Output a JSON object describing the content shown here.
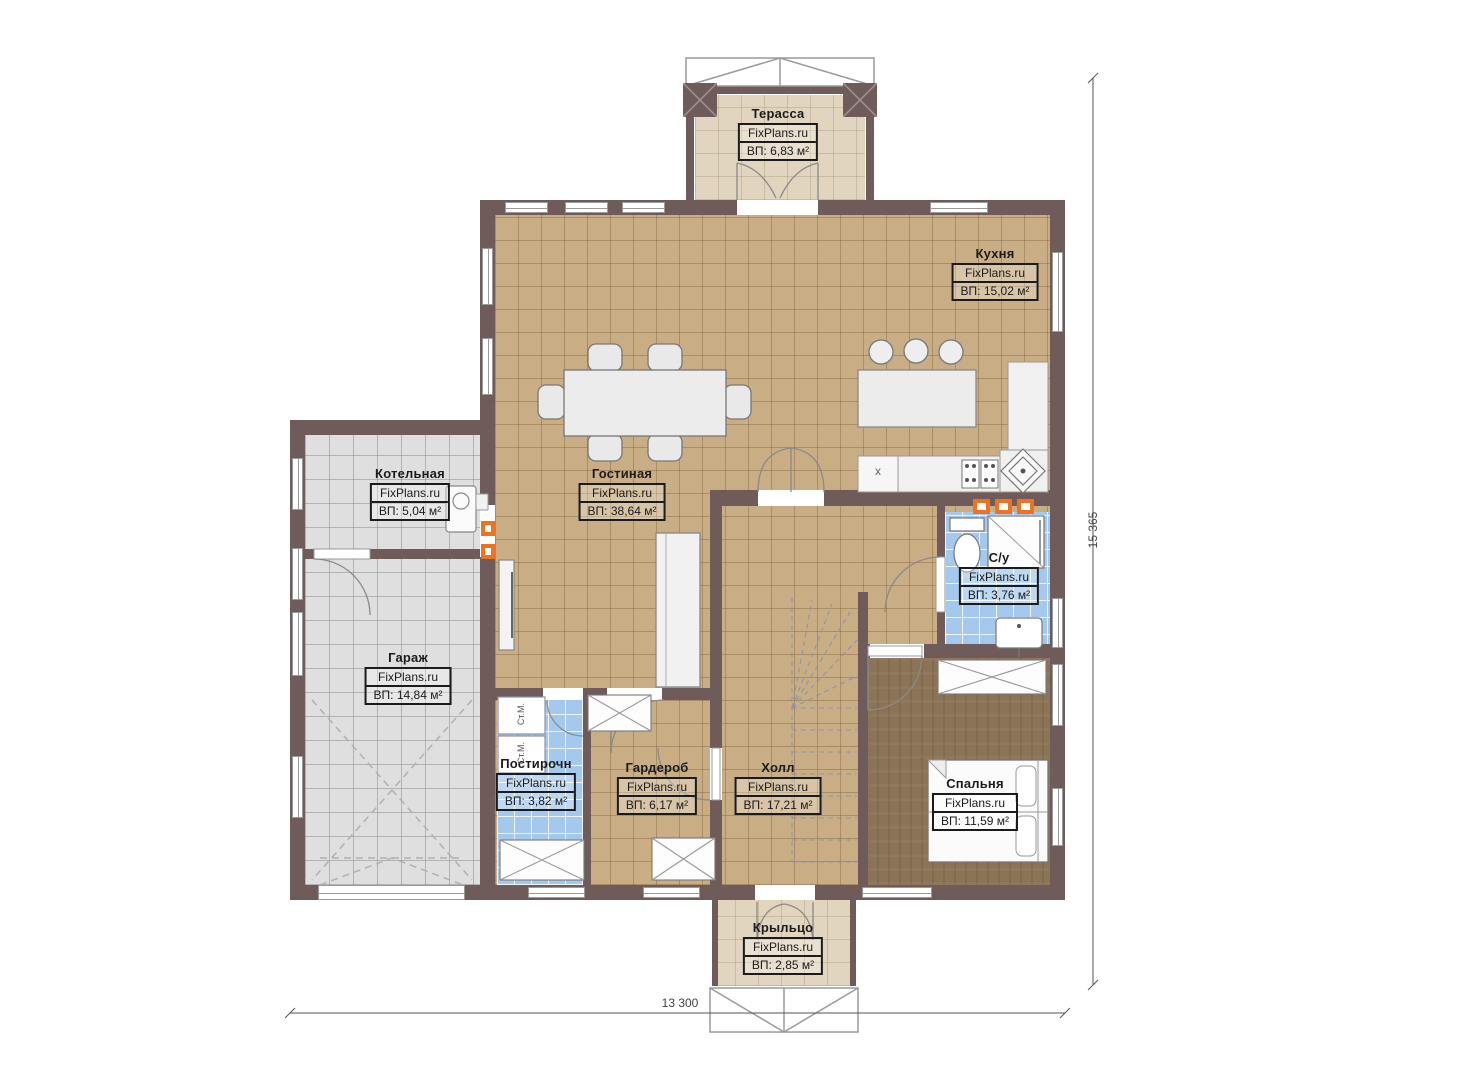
{
  "brand": "FixPlans.ru",
  "rooms": [
    {
      "id": "terrace",
      "name": "Терасса",
      "brand": "FixPlans.ru",
      "area": "ВП: 6,83 м²"
    },
    {
      "id": "kitchen",
      "name": "Кухня",
      "brand": "FixPlans.ru",
      "area": "ВП: 15,02 м²"
    },
    {
      "id": "living",
      "name": "Гостиная",
      "brand": "FixPlans.ru",
      "area": "ВП: 38,64 м²"
    },
    {
      "id": "boiler",
      "name": "Котельная",
      "brand": "FixPlans.ru",
      "area": "ВП: 5,04 м²"
    },
    {
      "id": "garage",
      "name": "Гараж",
      "brand": "FixPlans.ru",
      "area": "ВП: 14,84 м²"
    },
    {
      "id": "bathroom",
      "name": "С/у",
      "brand": "FixPlans.ru",
      "area": "ВП: 3,76 м²"
    },
    {
      "id": "laundry",
      "name": "Постирочн",
      "brand": "FixPlans.ru",
      "area": "ВП: 3,82 м²"
    },
    {
      "id": "wardrobe",
      "name": "Гардероб",
      "brand": "FixPlans.ru",
      "area": "ВП: 6,17 м²"
    },
    {
      "id": "hall",
      "name": "Холл",
      "brand": "FixPlans.ru",
      "area": "ВП: 17,21 м²"
    },
    {
      "id": "bedroom",
      "name": "Спальня",
      "brand": "FixPlans.ru",
      "area": "ВП: 11,59 м²"
    },
    {
      "id": "porch",
      "name": "Крыльцо",
      "brand": "FixPlans.ru",
      "area": "ВП: 2,85 м²"
    }
  ],
  "dimensions": {
    "width": "13 300",
    "height": "15 365"
  },
  "appliances": {
    "washer": "Ст.М.",
    "sink_mark": "x"
  },
  "colors": {
    "wall": "#6e5b5a",
    "floor_tan": "#c9ae85",
    "floor_gray": "#dfdfdf",
    "floor_blue": "#a5c9ee",
    "floor_wood": "#8b7356",
    "floor_beige": "#e1d5bf",
    "accent_orange": "#ed7222"
  }
}
